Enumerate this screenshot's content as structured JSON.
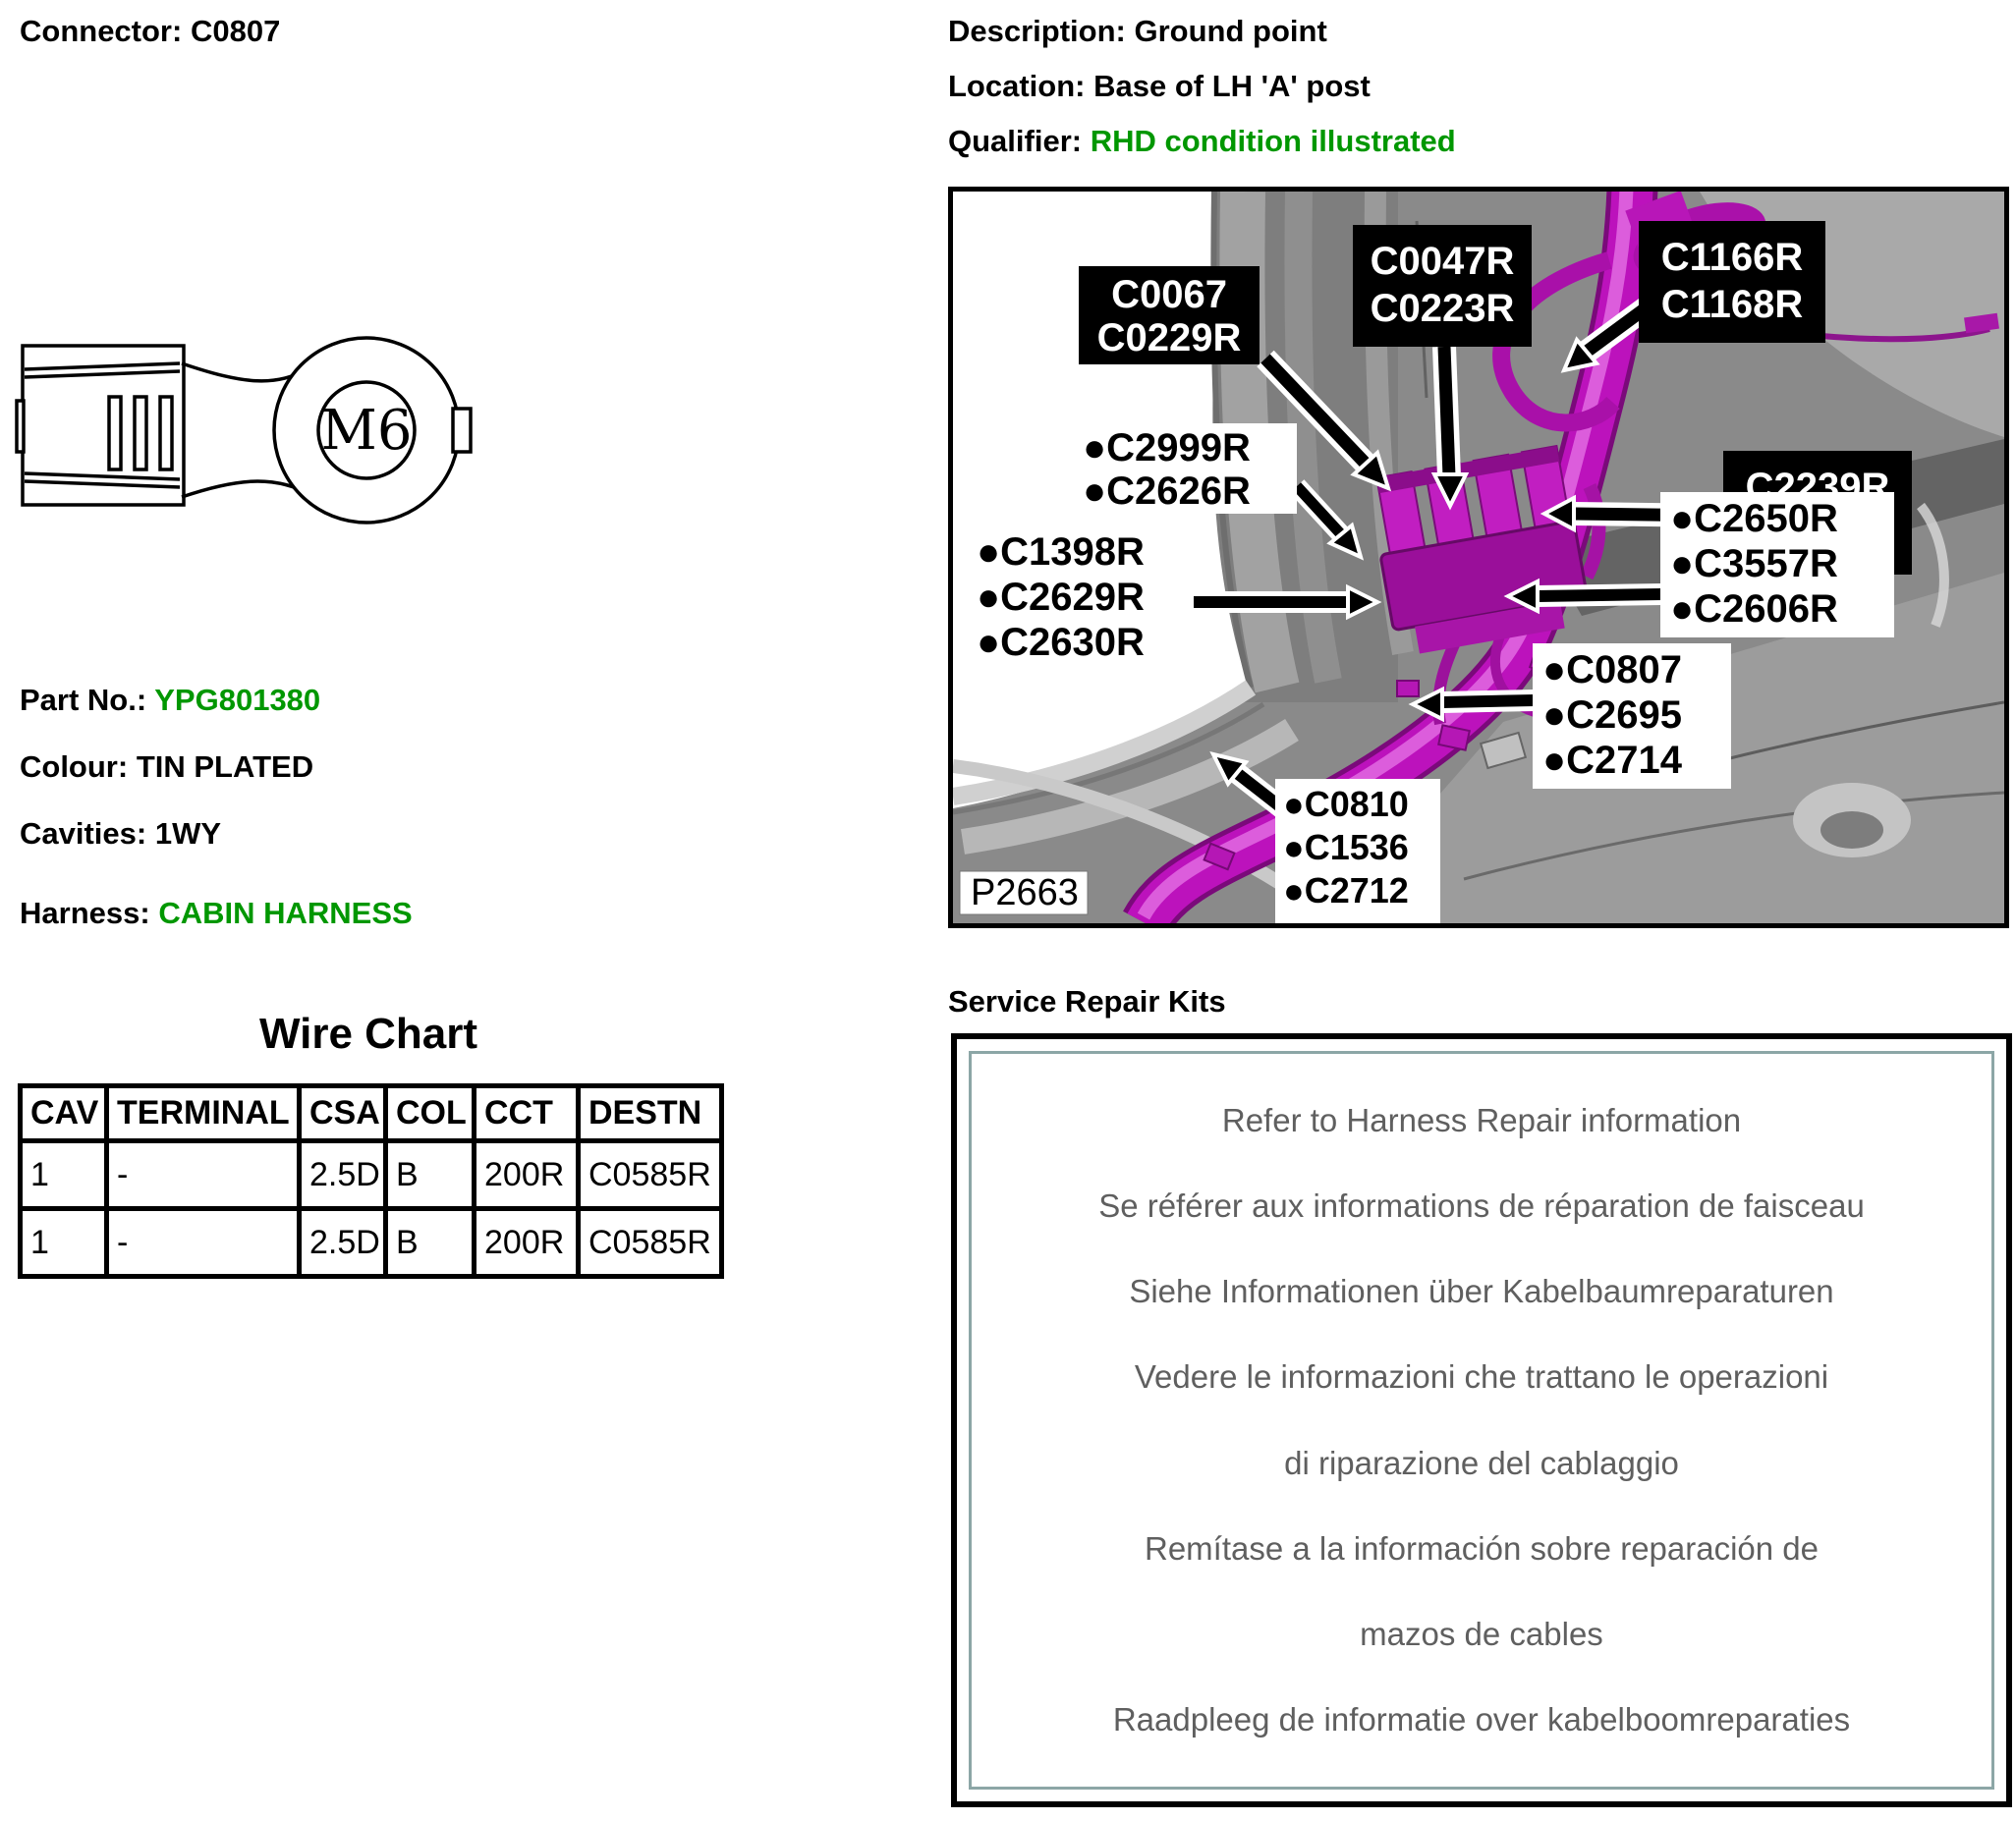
{
  "connector": {
    "label": "Connector:",
    "value": "C0807"
  },
  "header_right": {
    "description_label": "Description:",
    "description": "Ground point",
    "location_label": "Location:",
    "location": "Base of LH 'A' post",
    "qualifier_label": "Qualifier:",
    "qualifier": "RHD condition illustrated"
  },
  "terminal": {
    "size": "M6"
  },
  "info": {
    "part_no_label": "Part No.:",
    "part_no": "YPG801380",
    "colour_label": "Colour:",
    "colour": "TIN PLATED",
    "cavities_label": "Cavities:",
    "cavities": "1WY",
    "harness_label": "Harness:",
    "harness": "CABIN HARNESS"
  },
  "wire_chart": {
    "title": "Wire Chart",
    "headers": [
      "CAV",
      "TERMINAL",
      "CSA",
      "COL",
      "CCT",
      "DESTN"
    ],
    "rows": [
      [
        "1",
        "-",
        "2.5D",
        "B",
        "200R",
        "C0585R"
      ],
      [
        "1",
        "-",
        "2.5D",
        "B",
        "200R",
        "C0585R"
      ]
    ]
  },
  "figure": {
    "ref_label": "P2663",
    "black_labels": [
      [
        "C0067",
        "C0229R"
      ],
      [
        "C0047R",
        "C0223R"
      ],
      [
        "C1166R",
        "C1168R"
      ],
      [
        "C2239R",
        "C2241R"
      ]
    ],
    "bullet_labels": [
      [
        "●C2999R",
        "●C2626R"
      ],
      [
        "●C1398R",
        "●C2629R",
        "●C2630R"
      ],
      [
        "●C2650R",
        "●C3557R",
        "●C2606R"
      ],
      [
        "●C0807",
        "●C2695",
        "●C2714"
      ],
      [
        "●C0810",
        "●C1536",
        "●C2712"
      ]
    ]
  },
  "service": {
    "title": "Service Repair Kits",
    "lines": [
      "Refer to Harness Repair information",
      "Se référer aux informations de réparation de faisceau",
      "Siehe Informationen über Kabelbaumreparaturen",
      "Vedere le informazioni che trattano le operazioni",
      "di riparazione del cablaggio",
      "Remítase a la información sobre reparación de",
      "mazos de cables",
      "Raadpleeg de informatie over kabelboomreparaties"
    ]
  },
  "colors": {
    "accent_green": "#009700",
    "harness_magenta": "#bc12bc",
    "label_bg": "#000000"
  }
}
